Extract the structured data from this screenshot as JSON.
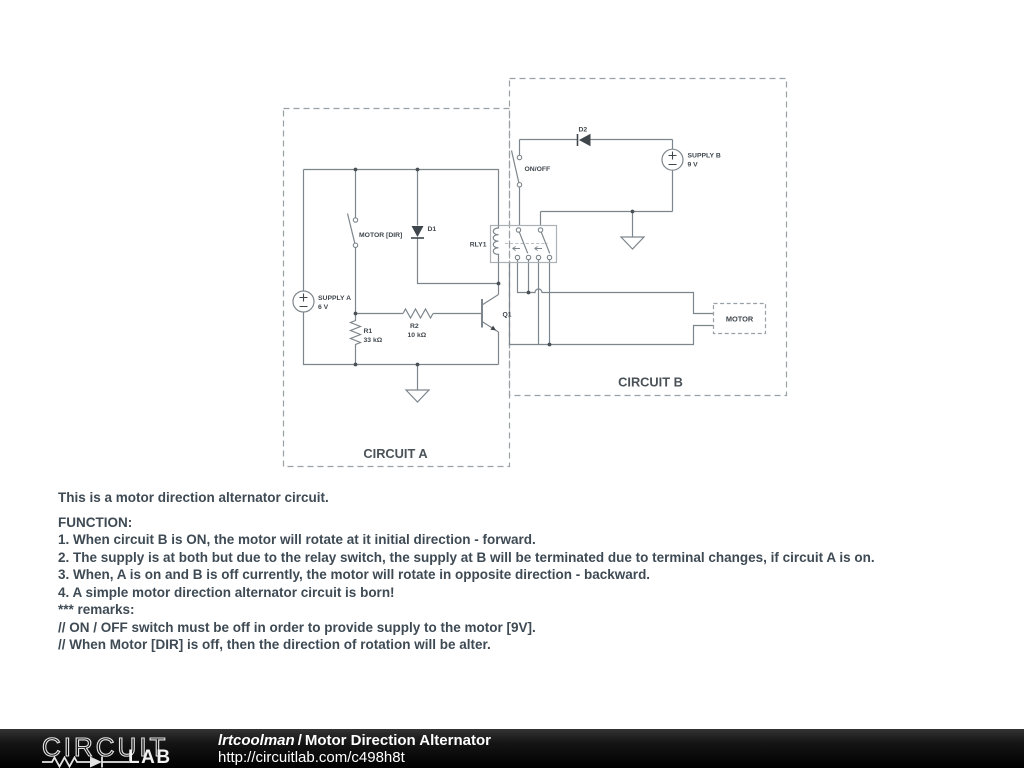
{
  "colors": {
    "wire": "#7d868c",
    "component_label": "#3f474d",
    "dashed_border": "#9aa1a6",
    "relay_box": "#abb1b5",
    "body_text": "#3e4a54",
    "footer_bg": "#000000",
    "footer_text": "#ffffff"
  },
  "schematic": {
    "circuit_a": {
      "label": "CIRCUIT A",
      "switch_label": "MOTOR [DIR]",
      "d1": "D1",
      "supply_name": "SUPPLY A",
      "supply_value": "6 V",
      "r1_name": "R1",
      "r1_value": "33 kΩ",
      "r2_name": "R2",
      "r2_value": "10 kΩ",
      "q1": "Q1"
    },
    "circuit_b": {
      "label": "CIRCUIT B",
      "d2": "D2",
      "switch_label": "ON/OFF",
      "supply_name": "SUPPLY B",
      "supply_value": "9 V",
      "relay": "RLY1",
      "motor": "MOTOR"
    }
  },
  "description": {
    "intro": "This is a motor direction alternator circuit.",
    "lines": [
      "FUNCTION:",
      "1. When circuit B is ON, the motor will rotate at it initial direction - forward.",
      "2. The supply is at both but due to the relay switch, the supply at B will be terminated due to terminal changes, if circuit A is on.",
      "3. When, A is on and B is off currently, the motor will rotate in opposite direction - backward.",
      "4. A simple motor direction alternator circuit is born!",
      "*** remarks:",
      "// ON / OFF switch must be off in order to provide supply to the motor [9V].",
      "// When Motor [DIR] is off, then the direction of rotation will be alter."
    ]
  },
  "footer": {
    "logo_word": "CIRCUIT",
    "logo_lab": "LAB",
    "author": "lrtcoolman",
    "separator": "/",
    "title": "Motor Direction Alternator",
    "url": "http://circuitlab.com/c498h8t"
  }
}
